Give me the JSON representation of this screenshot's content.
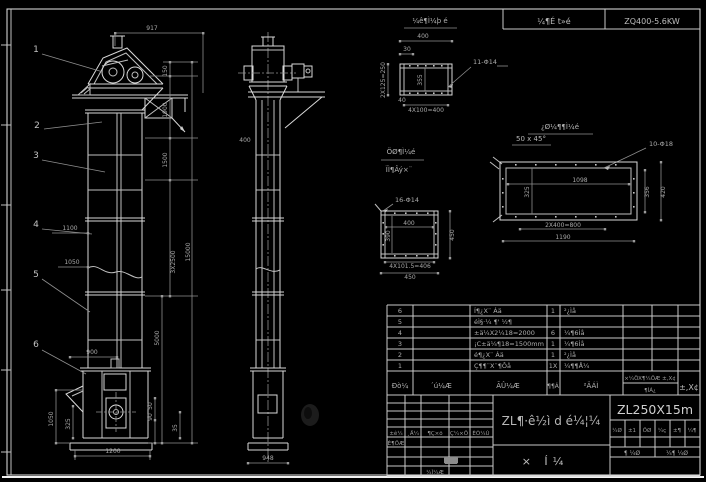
{
  "header": {
    "left_cell": "¼¶É t»é",
    "right_cell": "ZQ400-5.6KW"
  },
  "front": {
    "balloons": [
      "1",
      "2",
      "3",
      "4",
      "5",
      "6"
    ],
    "dims": {
      "w917": "917",
      "d150": "150",
      "d1900": "1900",
      "d1500": "1500",
      "d3x2500": "3X2500",
      "d5000": "5000",
      "total": "15000",
      "d1100": "1100",
      "d1050": "1050",
      "d900": "900",
      "boot_h": "1050",
      "d325": "325",
      "boot_w": "1200",
      "d50": "50",
      "d90": "90",
      "d35": "35"
    }
  },
  "side": {
    "dims": {
      "d400": "400",
      "base": "948"
    }
  },
  "details": {
    "a": {
      "title": "¼ê¶Ì¼þ é",
      "scale_top": "400",
      "d30": "30",
      "left_rot": "2X125=250",
      "d355": "355",
      "holes": "11-Φ14",
      "d40": "40",
      "bottom": "4X100=400",
      "chamfer": "50 x 45°"
    },
    "b": {
      "label1": "ÖØ¶Ì¼é",
      "label2": "ÏÌ¶Âý×¨",
      "holes": "16-Φ14",
      "d400": "400",
      "d390": "390",
      "row1": "4X101.5=406",
      "row2": "450",
      "right": "450"
    },
    "c": {
      "label": "¿Ø¼¶¶Ì¼é",
      "holes": "10-Φ18",
      "d1098": "1098",
      "d325": "325",
      "row1": "2X400=800",
      "row2": "1190",
      "r1": "356",
      "r2": "420"
    }
  },
  "bom": {
    "headers": {
      "no": "Ðò¼",
      "code": "´ú¼Æ",
      "name": "ÃÛ¼Æ",
      "qty": "¶¶Á",
      "material": "²ÄÁÌ",
      "w1": "×¼ÖX¶¼ÖÆ ±,X¢",
      "w2": "¶ÌÁ¿",
      "remark": "±,X¢"
    },
    "rows": [
      {
        "no": "6",
        "name": "Í¶¿X¨ Áä",
        "qty": "1",
        "material": "²¿Ìå"
      },
      {
        "no": "5",
        "name": "éÌ§·¼ ¶' ½¶",
        "qty": "",
        "material": ""
      },
      {
        "no": "4",
        "name": "±ä¼X2¼18=2000",
        "qty": "6",
        "material": "¼¶6Ìå"
      },
      {
        "no": "3",
        "name": "¡C±ä¼¶18=1500mm",
        "qty": "1",
        "material": "¼¶6Ìå"
      },
      {
        "no": "2",
        "name": "é¶¿X¨ Áä",
        "qty": "1",
        "material": "²¿Ìå"
      },
      {
        "no": "1",
        "name": "Ç¶¶¨X¨¶Ôå",
        "qty": "1X",
        "material": "¼¶¶Å¼"
      }
    ]
  },
  "titleblock": {
    "rev_headers": [
      "±ê¼",
      "¸Ä¼",
      "¶Ç×ö",
      "Ç¼×Ö",
      "ÈÕ¼Ú"
    ],
    "design": "É¶ÖÆ",
    "check": "¼Ì¼Æ",
    "title": "ZL¶·ê½ì d é¼¦¼",
    "subtitle": "× Í¼",
    "model": "ZL250X15m",
    "small": [
      "¼Ø",
      "±1",
      "ÖØ",
      "¼ç",
      "±¶",
      "¼¶"
    ],
    "sheet1": "¶ ¼Ø",
    "sheet2": "¼¶ ¼Ø"
  },
  "colors": {
    "background": "#000000",
    "line": "#d9d9d9",
    "dim": "#8f8f8f",
    "text": "#b2b2b2"
  }
}
